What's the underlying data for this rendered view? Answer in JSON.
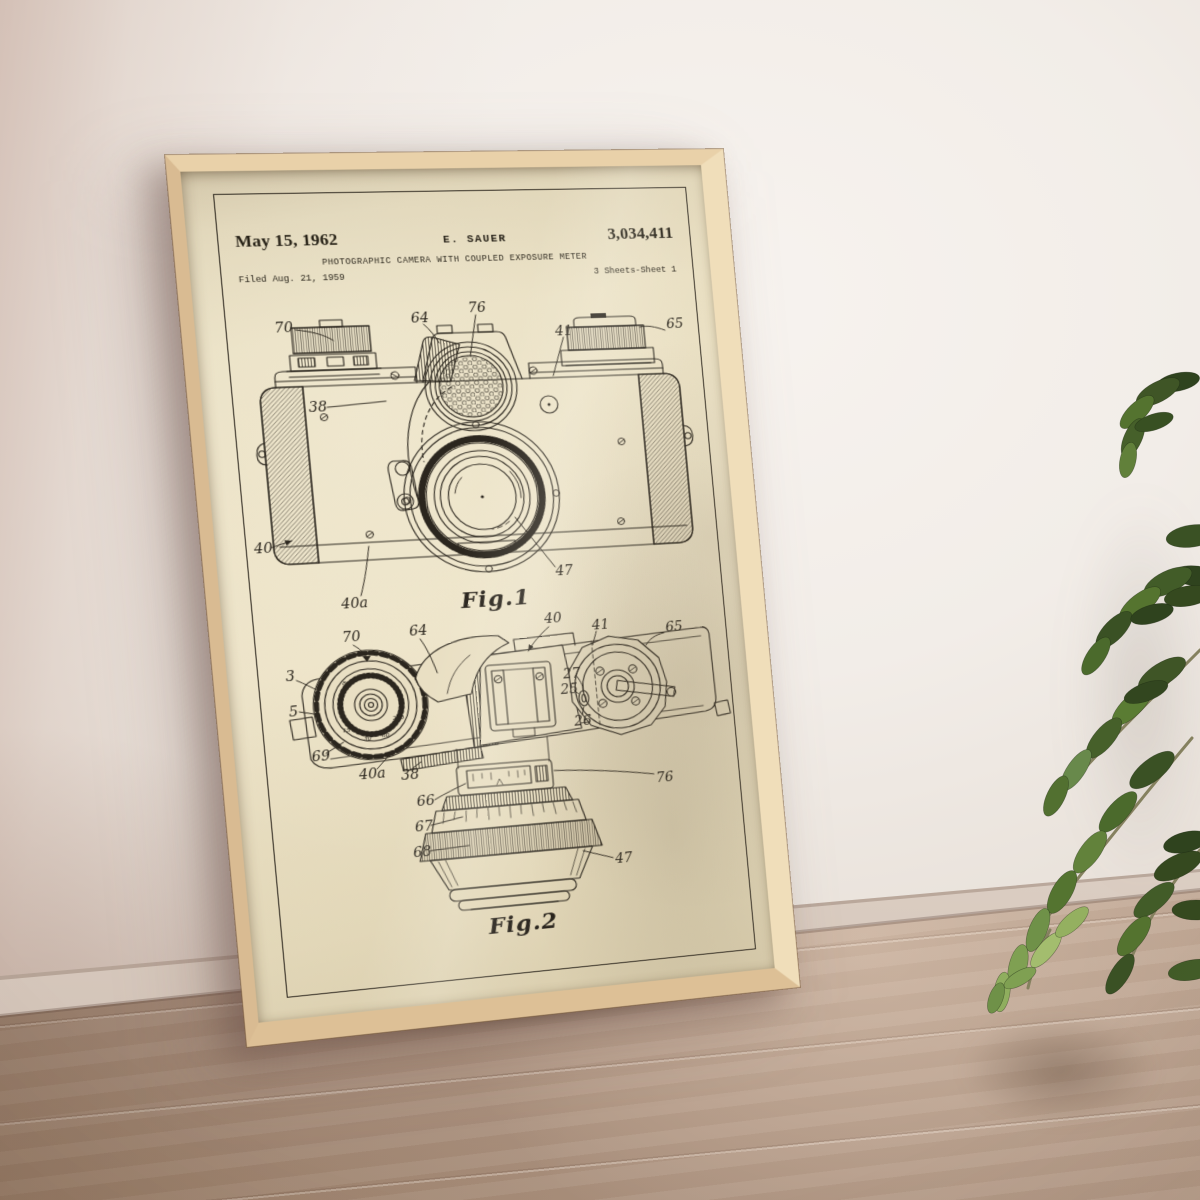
{
  "scene": {
    "description": "Framed vintage camera patent print leaning against a white wall on a wooden floor, green houseplant at right",
    "palette": {
      "wall": "#f2eee9",
      "wall_shadow": "#d2bcb1",
      "baseboard": "#e6dbd1",
      "floor_light": "#d4c0af",
      "floor_dark": "#a78c7a",
      "frame_wood": "#e9d1a9",
      "frame_wood_dark": "#cfae83",
      "paper": "#e9dfc3",
      "ink": "#2b261e",
      "leaf_dark": "#2f431e",
      "leaf_light": "#8fae5e"
    }
  },
  "poster": {
    "header": {
      "date": "May 15, 1962",
      "inventor": "E. SAUER",
      "patent_number": "3,034,411",
      "title": "PHOTOGRAPHIC CAMERA WITH COUPLED EXPOSURE METER",
      "filed": "Filed Aug. 21, 1959",
      "sheet": "3 Sheets-Sheet 1"
    },
    "fig1": {
      "caption": "Fig.1",
      "labels": {
        "70": "70",
        "64": "64",
        "76": "76",
        "41": "41",
        "65": "65",
        "38": "38",
        "40": "40",
        "40a": "40a",
        "47": "47"
      }
    },
    "fig2": {
      "caption": "Fig.2",
      "labels": {
        "70": "70",
        "64": "64",
        "40": "40",
        "41": "41",
        "65": "65",
        "3": "3",
        "5": "5",
        "27": "27",
        "25": "25",
        "26": "26",
        "69": "69",
        "40a": "40a",
        "38": "38",
        "76": "76",
        "66": "66",
        "67": "67",
        "68": "68",
        "47": "47"
      },
      "dial_numbers": [
        "8",
        "15",
        "30",
        "60",
        "250"
      ]
    }
  }
}
